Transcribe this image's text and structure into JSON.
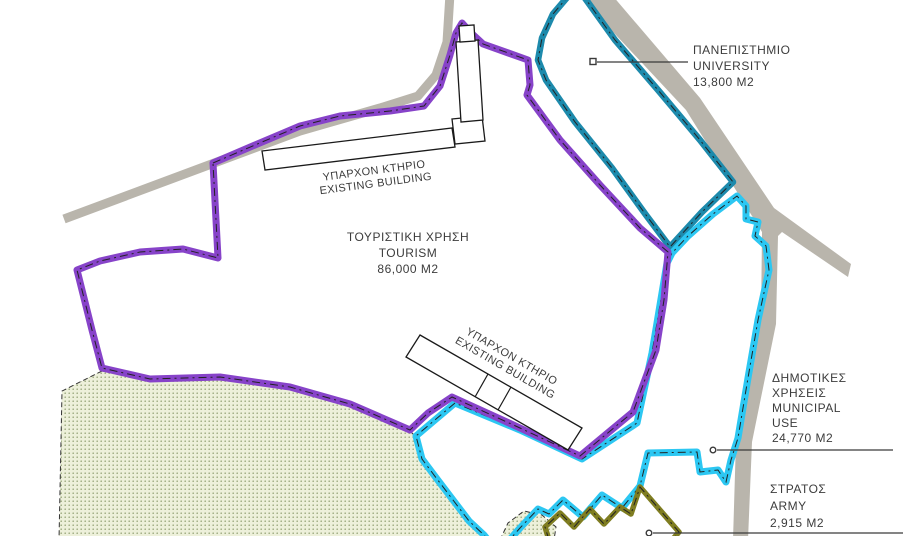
{
  "zones": {
    "university": {
      "lines": [
        "ΠΑΝΕΠΙΣΤΗΜΙΟ",
        "UNIVERSITY",
        "13,800 M2"
      ],
      "color": "#1d8aac"
    },
    "tourism": {
      "lines": [
        "ΤΟΥΡΙΣΤΙΚΗ ΧΡΗΣΗ",
        "TOURISM",
        "86,000 M2"
      ],
      "color": "#8743c9"
    },
    "municipal": {
      "lines": [
        "ΔΗΜΟΤΙΚΕΣ",
        "ΧΡΗΣΕΙΣ",
        "MUNICIPAL",
        "USE",
        "24,770 M2"
      ],
      "color": "#2cc7f2"
    },
    "army": {
      "lines": [
        "ΣΤΡΑΤΟΣ",
        "ARMY",
        "2,915 M2"
      ],
      "color": "#7f7d21"
    }
  },
  "buildings": {
    "upper": {
      "lines": [
        "ΥΠΑΡΧΟΝ ΚΤΗΡΙΟ",
        "EXISTING BUILDING"
      ]
    },
    "lower": {
      "lines": [
        "ΥΠΑΡΧΟΝ ΚΤΗΡΙΟ",
        "EXISTING BUILDING"
      ]
    }
  },
  "palette": {
    "road": "#b9b5ac",
    "green_fill": "#edf0da",
    "green_dot": "#9aa87c",
    "leader_line": "#3a3a3a",
    "background": "#ffffff"
  }
}
